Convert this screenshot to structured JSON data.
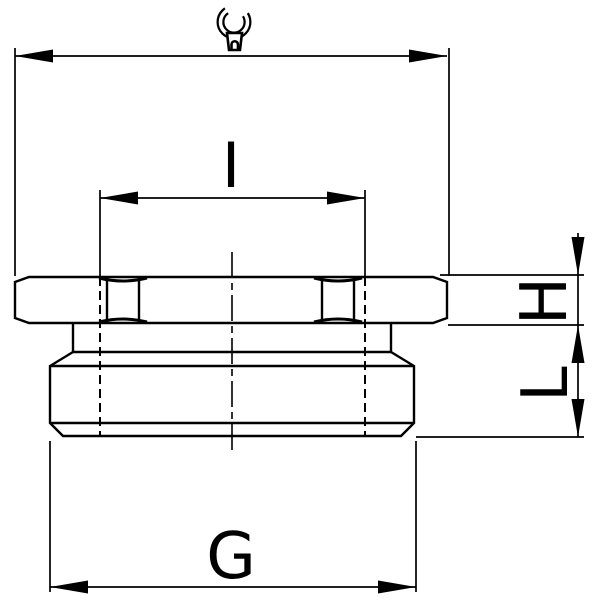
{
  "colors": {
    "background": "#ffffff",
    "line": "#000000"
  },
  "labels": {
    "inner_diameter": "I",
    "hex_height": "H",
    "body_length": "L",
    "thread_diameter": "G"
  },
  "icons": {
    "wrench": "open-end-wrench-icon"
  }
}
